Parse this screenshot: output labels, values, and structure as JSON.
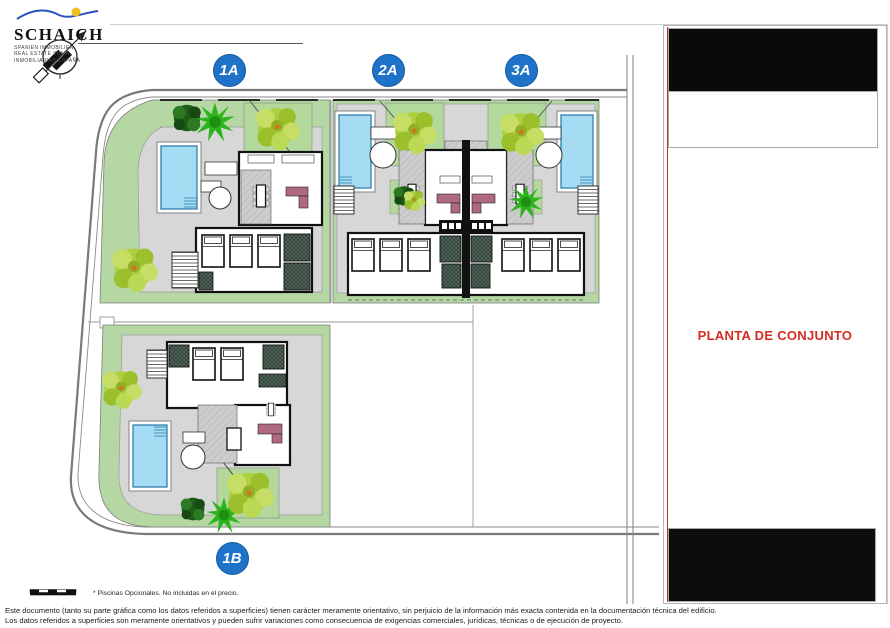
{
  "logo": {
    "brand": "SCHAICH",
    "taglines": [
      "SPANIEN IMMOBILIEN",
      "REAL ESTATE SPAIN",
      "INMOBILIARIAS ESPAÑA"
    ]
  },
  "plan": {
    "units": [
      {
        "label": "1A"
      },
      {
        "label": "2A"
      },
      {
        "label": "3A"
      },
      {
        "label": "1B"
      }
    ]
  },
  "side_panel": {
    "title": "PLANTA DE CONJUNTO"
  },
  "footer": {
    "pool_note": "* Piscinas Opcionales. No incluidas en el precio.",
    "disclaimer_line1": "Este documento (tanto su parte gráfica como los datos referidos a superficies) tienen carácter meramente orientativo, sin perjuicio de la información más exacta contenida en la documentación técnica del edificio.",
    "disclaimer_line2": "Los datos referidos a superficies son meramente orientativos y pueden sufrir variaciones como consecuencia de exigencias comerciales, jurídicas, técnicas o de ejecución de proyecto."
  },
  "icons": {
    "north_arrow": "north-arrow-compass",
    "scale_bar": "graphic-scale-bar"
  },
  "colors": {
    "accent_red": "#d42b22",
    "label_blue": "#1e72c8",
    "pool_blue": "#a5dcf3",
    "garden_green": "#b5d7a3",
    "lawn_green": "#b2d89c",
    "plot_gray": "#d7d7d7",
    "road_gray": "#8a8a8a",
    "wall_black": "#111111",
    "sofa_mauve": "#b06a80",
    "tree_yellow_green": "#aecf3f",
    "tree_green": "#2db31d",
    "tree_dark_green": "#1e5c18",
    "logo_wave_blue": "#2a52be",
    "logo_sun_yellow": "#f0c020"
  }
}
